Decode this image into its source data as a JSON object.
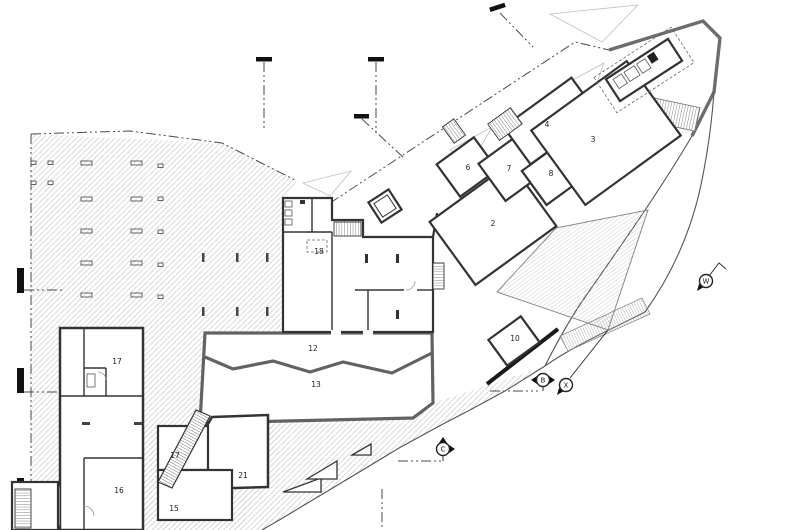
{
  "drawing": {
    "type": "architectural-floor-plan",
    "rooms": [
      {
        "id": "2",
        "x": 493,
        "y": 226
      },
      {
        "id": "3",
        "x": 593,
        "y": 142
      },
      {
        "id": "4",
        "x": 547,
        "y": 127
      },
      {
        "id": "6",
        "x": 468,
        "y": 170
      },
      {
        "id": "7",
        "x": 509,
        "y": 171
      },
      {
        "id": "8",
        "x": 551,
        "y": 176
      },
      {
        "id": "10",
        "x": 515,
        "y": 341
      },
      {
        "id": "12",
        "x": 313,
        "y": 351
      },
      {
        "id": "13",
        "x": 316,
        "y": 387
      },
      {
        "id": "15",
        "x": 174,
        "y": 511
      },
      {
        "id": "16",
        "x": 119,
        "y": 493
      },
      {
        "id": "17",
        "x": 117,
        "y": 364
      },
      {
        "id": "17",
        "x": 175,
        "y": 458
      },
      {
        "id": "18",
        "x": 319,
        "y": 254
      },
      {
        "id": "21",
        "x": 243,
        "y": 478
      }
    ],
    "markers": [
      {
        "label": "B",
        "x": 543,
        "y": 380,
        "arrows": [
          "left",
          "right"
        ]
      },
      {
        "label": "X",
        "x": 566,
        "y": 385,
        "arrows": [
          "bottom-left"
        ]
      },
      {
        "label": "C",
        "x": 443,
        "y": 449,
        "arrows": [
          "top",
          "right"
        ]
      },
      {
        "label": "W",
        "x": 706,
        "y": 281,
        "arrows": [
          "bottom-left"
        ]
      }
    ],
    "colors": {
      "wall": "#333333",
      "hall-wall": "#5f6368",
      "boundary": "#4a4a4a",
      "hatch-line": "#d2d2d2",
      "deck-stripe": "#b5b9be",
      "paper": "#ffffff"
    }
  }
}
